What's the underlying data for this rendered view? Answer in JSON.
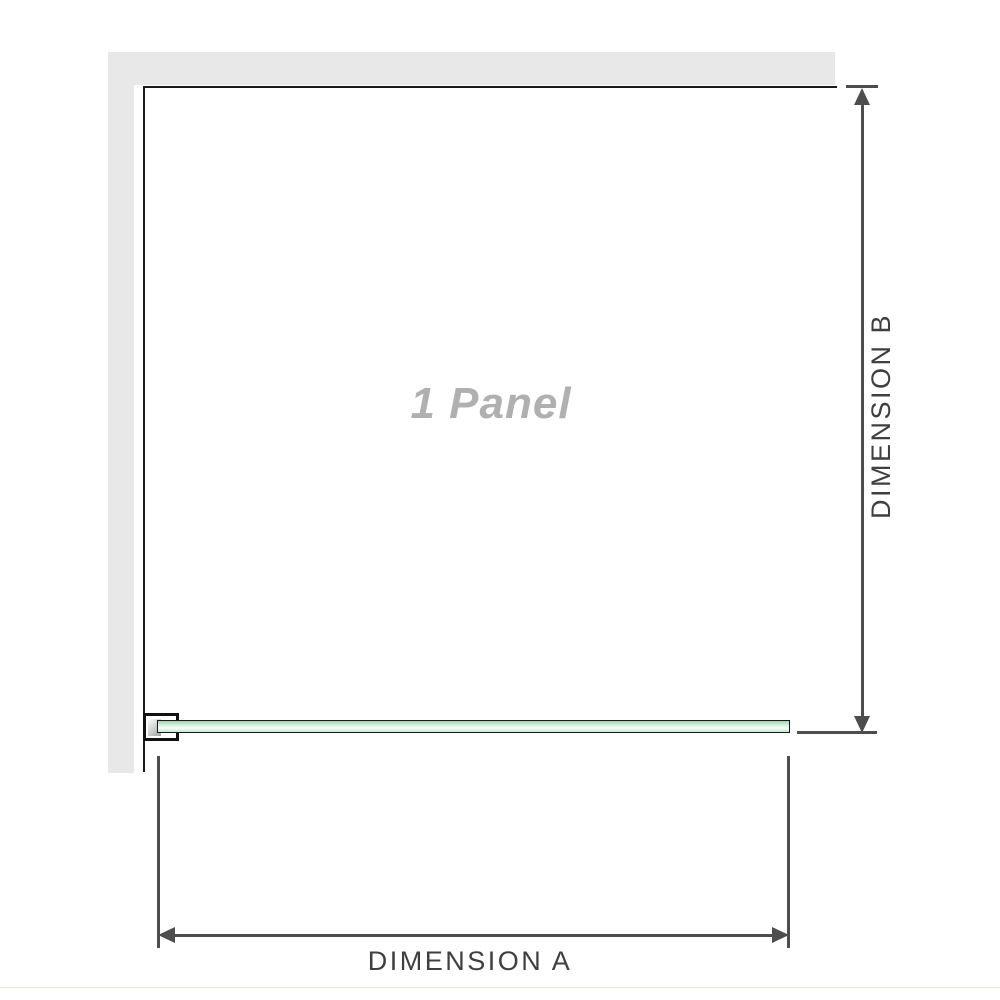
{
  "diagram": {
    "panel_label": "1 Panel",
    "dimension_a_label": "DIMENSION A",
    "dimension_b_label": "DIMENSION B",
    "colors": {
      "wall_gray": "#e8e8e8",
      "panel_outline": "#1a1a1a",
      "glass_green": "#b7dfc4",
      "glass_highlight": "#f9fdfa",
      "dimension_line": "#4d4d4d",
      "panel_label_gray": "#b0b0b0",
      "dimension_text": "#3f3f3f"
    }
  }
}
